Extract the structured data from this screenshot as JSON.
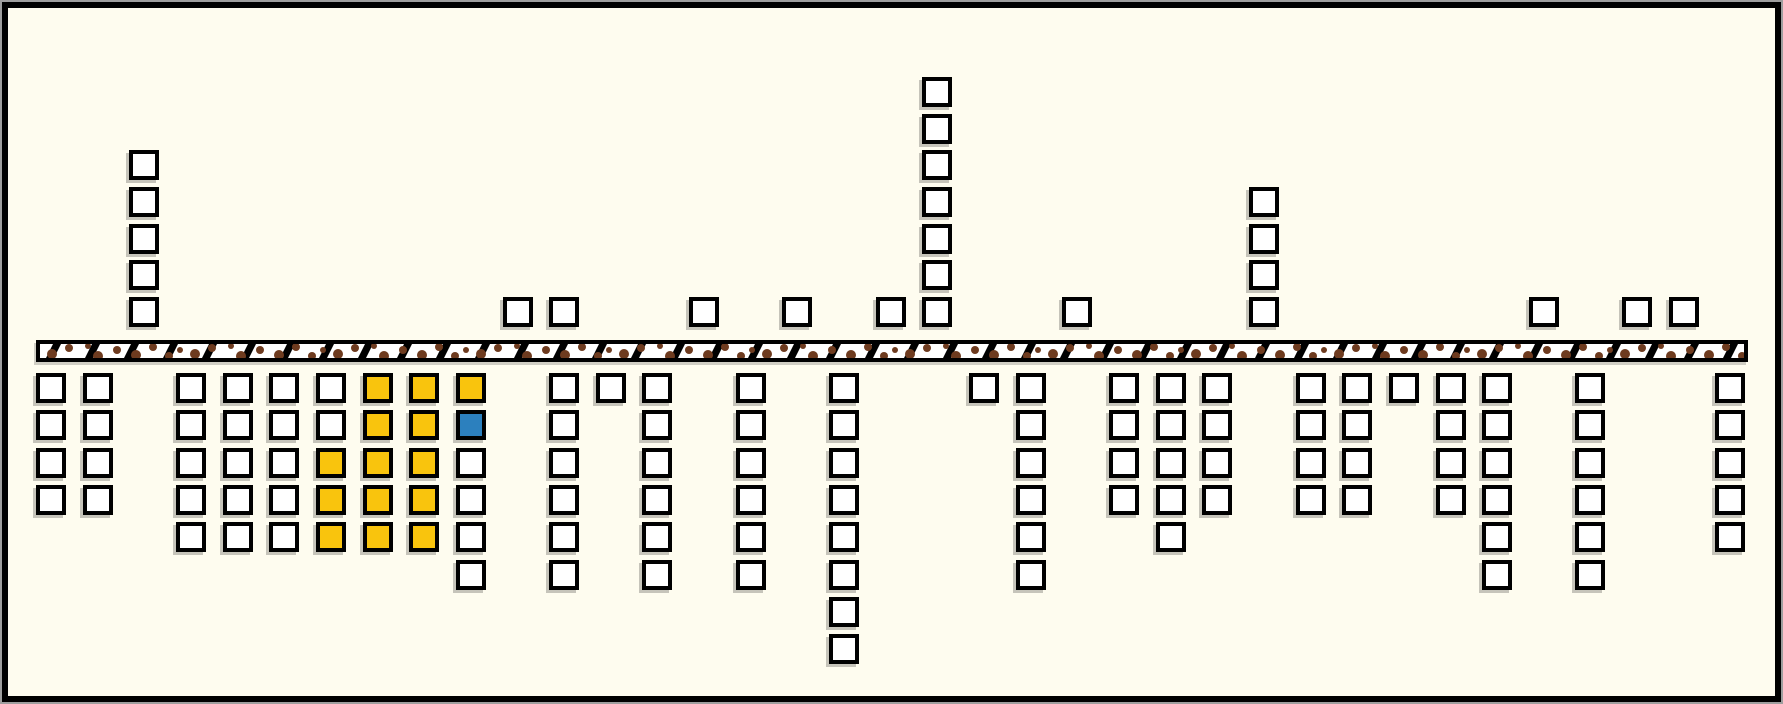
{
  "canvas": {
    "width": 1783,
    "height": 704,
    "background_color": "#FEFCEF",
    "frame_color": "#000000",
    "frame_outline_color": "#9E9E9E"
  },
  "road": {
    "fill_color": "#FFFFFF",
    "border_color": "#000000",
    "stripe_color": "#000000",
    "spot_color": "#6E3B1F"
  },
  "markers": {
    "default_fill": "#FFFFFF",
    "border_color": "#000000",
    "highlight_fill": "#F9C40D",
    "active_fill": "#2C80BE",
    "shadow_color": "rgba(0,0,0,0.22)"
  },
  "chart_data": {
    "type": "pictograph",
    "description": "37 grid columns of outlined square markers stacked above and below a horizontal black-bordered band hatched with diagonal black stripes and brown spots. Below the band, a cluster of 14 squares is highlighted yellow and one square is blue; all other squares are white.",
    "above_counts": [
      0,
      0,
      5,
      0,
      0,
      0,
      0,
      0,
      0,
      0,
      1,
      1,
      0,
      0,
      1,
      0,
      1,
      0,
      1,
      7,
      0,
      0,
      1,
      0,
      0,
      0,
      4,
      0,
      0,
      0,
      0,
      0,
      1,
      0,
      1,
      1,
      0
    ],
    "below_counts": [
      4,
      4,
      0,
      5,
      5,
      5,
      5,
      5,
      5,
      6,
      0,
      6,
      1,
      6,
      0,
      6,
      0,
      8,
      0,
      0,
      1,
      6,
      0,
      4,
      5,
      4,
      0,
      4,
      4,
      1,
      4,
      6,
      0,
      6,
      0,
      0,
      5
    ],
    "below_yellow_cells": [
      [
        6,
        2
      ],
      [
        6,
        3
      ],
      [
        6,
        4
      ],
      [
        7,
        0
      ],
      [
        7,
        1
      ],
      [
        7,
        2
      ],
      [
        7,
        3
      ],
      [
        7,
        4
      ],
      [
        8,
        0
      ],
      [
        8,
        1
      ],
      [
        8,
        2
      ],
      [
        8,
        3
      ],
      [
        8,
        4
      ],
      [
        9,
        0
      ]
    ],
    "below_blue_cells": [
      [
        9,
        1
      ]
    ],
    "cell_row_origin": "row 0 is the row adjacent to the band; rows count outward (up for above, down for below)",
    "totals": {
      "above_squares": 25,
      "below_squares": 121,
      "yellow_squares": 14,
      "blue_squares": 1
    },
    "layout_hints": {
      "x0": 34,
      "col_pitch": 46.65,
      "square_size": 30,
      "above_base_y": 295,
      "above_row_pitch": 36.7,
      "below_base_y": 371,
      "below_row_pitch": 37.3,
      "road": {
        "x": 34,
        "y": 338,
        "width": 1712,
        "height": 22
      },
      "grid_visible": false,
      "axis_labels_visible": false
    }
  }
}
